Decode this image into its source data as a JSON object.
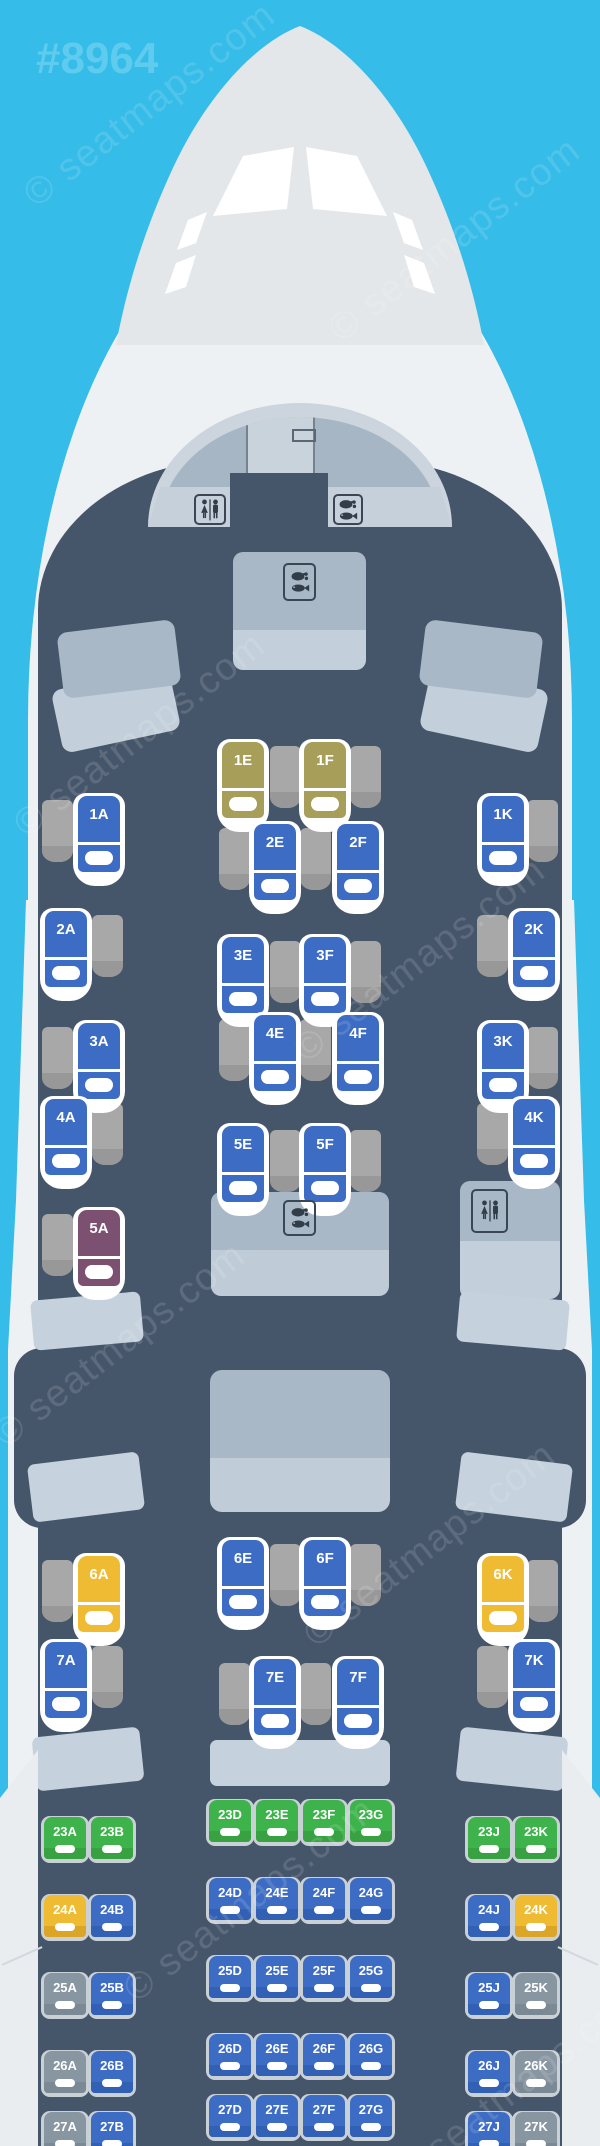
{
  "map_id": "#8964",
  "watermark_text": "© seatmaps.com",
  "palette": {
    "sky": "#36bce8",
    "fuselage": "#eef1f3",
    "nose_cap": "#e3e7ea",
    "cabin": "#46566a",
    "dome_ring": "#ccd5dd",
    "dome_side": "#a7b6c5",
    "dome_center": "#c9d3dc",
    "band": "#c5d0da",
    "furniture_top": "#a9b8c7",
    "furniture_bottom": "#c3cfda",
    "partition": "#c5d1dc",
    "wing": "#e9edf0",
    "table": "#a8a8a8",
    "table_dark": "#989898",
    "icon_dark": "#313d49",
    "icon_border": "#3a4654",
    "economy_frame": "#c9d0d6",
    "seat_colors": {
      "blue": {
        "main": "#3d6cc4",
        "strip": "#3160b4"
      },
      "olive": {
        "main": "#a79e5a",
        "strip": "#978f4e"
      },
      "plum": {
        "main": "#7c5070",
        "strip": "#6e4663"
      },
      "yellow": {
        "main": "#eebb33",
        "strip": "#dba528"
      },
      "green": {
        "main": "#3eb34c",
        "strip": "#38a243"
      },
      "gray": {
        "main": "#8896a2",
        "strip": "#7b8995"
      }
    }
  },
  "business": {
    "seats": [
      {
        "label": "1E",
        "x": 222,
        "y": 742,
        "color": "olive"
      },
      {
        "label": "1F",
        "x": 304,
        "y": 742,
        "color": "olive"
      },
      {
        "label": "1A",
        "x": 78,
        "y": 796,
        "color": "blue"
      },
      {
        "label": "1K",
        "x": 482,
        "y": 796,
        "color": "blue"
      },
      {
        "label": "2E",
        "x": 254,
        "y": 824,
        "color": "blue"
      },
      {
        "label": "2F",
        "x": 337,
        "y": 824,
        "color": "blue"
      },
      {
        "label": "2A",
        "x": 45,
        "y": 911,
        "color": "blue"
      },
      {
        "label": "2K",
        "x": 513,
        "y": 911,
        "color": "blue"
      },
      {
        "label": "3E",
        "x": 222,
        "y": 937,
        "color": "blue"
      },
      {
        "label": "3F",
        "x": 304,
        "y": 937,
        "color": "blue"
      },
      {
        "label": "3A",
        "x": 78,
        "y": 1023,
        "color": "blue"
      },
      {
        "label": "3K",
        "x": 482,
        "y": 1023,
        "color": "blue"
      },
      {
        "label": "4E",
        "x": 254,
        "y": 1015,
        "color": "blue"
      },
      {
        "label": "4F",
        "x": 337,
        "y": 1015,
        "color": "blue"
      },
      {
        "label": "4A",
        "x": 45,
        "y": 1099,
        "color": "blue"
      },
      {
        "label": "4K",
        "x": 513,
        "y": 1099,
        "color": "blue"
      },
      {
        "label": "5E",
        "x": 222,
        "y": 1126,
        "color": "blue"
      },
      {
        "label": "5F",
        "x": 304,
        "y": 1126,
        "color": "blue"
      },
      {
        "label": "5A",
        "x": 78,
        "y": 1210,
        "color": "plum"
      },
      {
        "label": "6E",
        "x": 222,
        "y": 1540,
        "color": "blue"
      },
      {
        "label": "6F",
        "x": 304,
        "y": 1540,
        "color": "blue"
      },
      {
        "label": "6A",
        "x": 78,
        "y": 1556,
        "color": "yellow"
      },
      {
        "label": "6K",
        "x": 482,
        "y": 1556,
        "color": "yellow"
      },
      {
        "label": "7A",
        "x": 45,
        "y": 1642,
        "color": "blue"
      },
      {
        "label": "7K",
        "x": 513,
        "y": 1642,
        "color": "blue"
      },
      {
        "label": "7E",
        "x": 254,
        "y": 1659,
        "color": "blue"
      },
      {
        "label": "7F",
        "x": 337,
        "y": 1659,
        "color": "blue"
      }
    ],
    "side_tables": [
      {
        "x": 270,
        "y": 746
      },
      {
        "x": 350,
        "y": 746
      },
      {
        "x": 42,
        "y": 800
      },
      {
        "x": 527,
        "y": 800
      },
      {
        "x": 219,
        "y": 828
      },
      {
        "x": 300,
        "y": 828
      },
      {
        "x": 92,
        "y": 915
      },
      {
        "x": 477,
        "y": 915
      },
      {
        "x": 270,
        "y": 941
      },
      {
        "x": 350,
        "y": 941
      },
      {
        "x": 42,
        "y": 1027
      },
      {
        "x": 527,
        "y": 1027
      },
      {
        "x": 219,
        "y": 1019
      },
      {
        "x": 300,
        "y": 1019
      },
      {
        "x": 92,
        "y": 1103
      },
      {
        "x": 477,
        "y": 1103
      },
      {
        "x": 270,
        "y": 1130
      },
      {
        "x": 350,
        "y": 1130
      },
      {
        "x": 42,
        "y": 1214
      },
      {
        "x": 270,
        "y": 1544
      },
      {
        "x": 350,
        "y": 1544
      },
      {
        "x": 42,
        "y": 1560
      },
      {
        "x": 527,
        "y": 1560
      },
      {
        "x": 219,
        "y": 1663
      },
      {
        "x": 300,
        "y": 1663
      },
      {
        "x": 92,
        "y": 1646
      },
      {
        "x": 477,
        "y": 1646
      }
    ]
  },
  "economy": {
    "columns": {
      "A": 44,
      "B": 91,
      "D": 209,
      "E": 256,
      "F": 303,
      "G": 350,
      "J": 468,
      "K": 515
    },
    "side_columns": [
      "A",
      "B",
      "J",
      "K"
    ],
    "rows": [
      {
        "row": "23",
        "y_center": 1800,
        "y_side": 1817,
        "seats": {
          "A": "green",
          "B": "green",
          "D": "green",
          "E": "green",
          "F": "green",
          "G": "green",
          "J": "green",
          "K": "green"
        }
      },
      {
        "row": "24",
        "y_center": 1878,
        "y_side": 1895,
        "seats": {
          "A": "yellow",
          "B": "blue",
          "D": "blue",
          "E": "blue",
          "F": "blue",
          "G": "blue",
          "J": "blue",
          "K": "yellow"
        }
      },
      {
        "row": "25",
        "y_center": 1956,
        "y_side": 1973,
        "seats": {
          "A": "gray",
          "B": "blue",
          "D": "blue",
          "E": "blue",
          "F": "blue",
          "G": "blue",
          "J": "blue",
          "K": "gray"
        }
      },
      {
        "row": "26",
        "y_center": 2034,
        "y_side": 2051,
        "seats": {
          "A": "gray",
          "B": "blue",
          "D": "blue",
          "E": "blue",
          "F": "blue",
          "G": "blue",
          "J": "blue",
          "K": "gray"
        }
      },
      {
        "row": "27",
        "y_center": 2095,
        "y_side": 2112,
        "seats": {
          "A": "gray",
          "B": "blue",
          "D": "blue",
          "E": "blue",
          "F": "blue",
          "G": "blue",
          "J": "blue",
          "K": "gray"
        }
      }
    ]
  },
  "facilities": [
    {
      "type": "lavatory",
      "x": 194,
      "y": 494,
      "w": 32,
      "h": 31
    },
    {
      "type": "galley-meal",
      "x": 333,
      "y": 494,
      "w": 30,
      "h": 31
    },
    {
      "type": "galley-meal",
      "x": 283,
      "y": 563,
      "w": 33,
      "h": 38
    },
    {
      "type": "galley-meal",
      "x": 283,
      "y": 1200,
      "w": 33,
      "h": 36
    },
    {
      "type": "lavatory",
      "x": 471,
      "y": 1189,
      "w": 37,
      "h": 44
    }
  ]
}
